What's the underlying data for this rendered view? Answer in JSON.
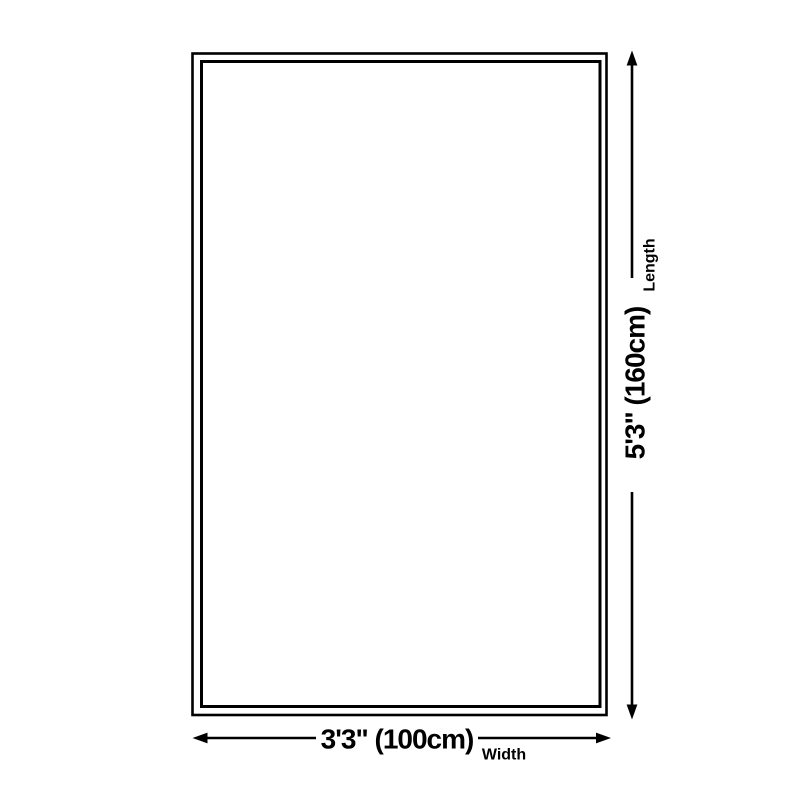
{
  "diagram": {
    "type": "product-size-diagram",
    "background_color": "#ffffff",
    "ink_color": "#000000",
    "dimensions": {
      "width": {
        "value": "3'3\" (100cm)",
        "label": "Width"
      },
      "length": {
        "value": "5'3\" (160cm)",
        "label": "Length"
      }
    }
  }
}
